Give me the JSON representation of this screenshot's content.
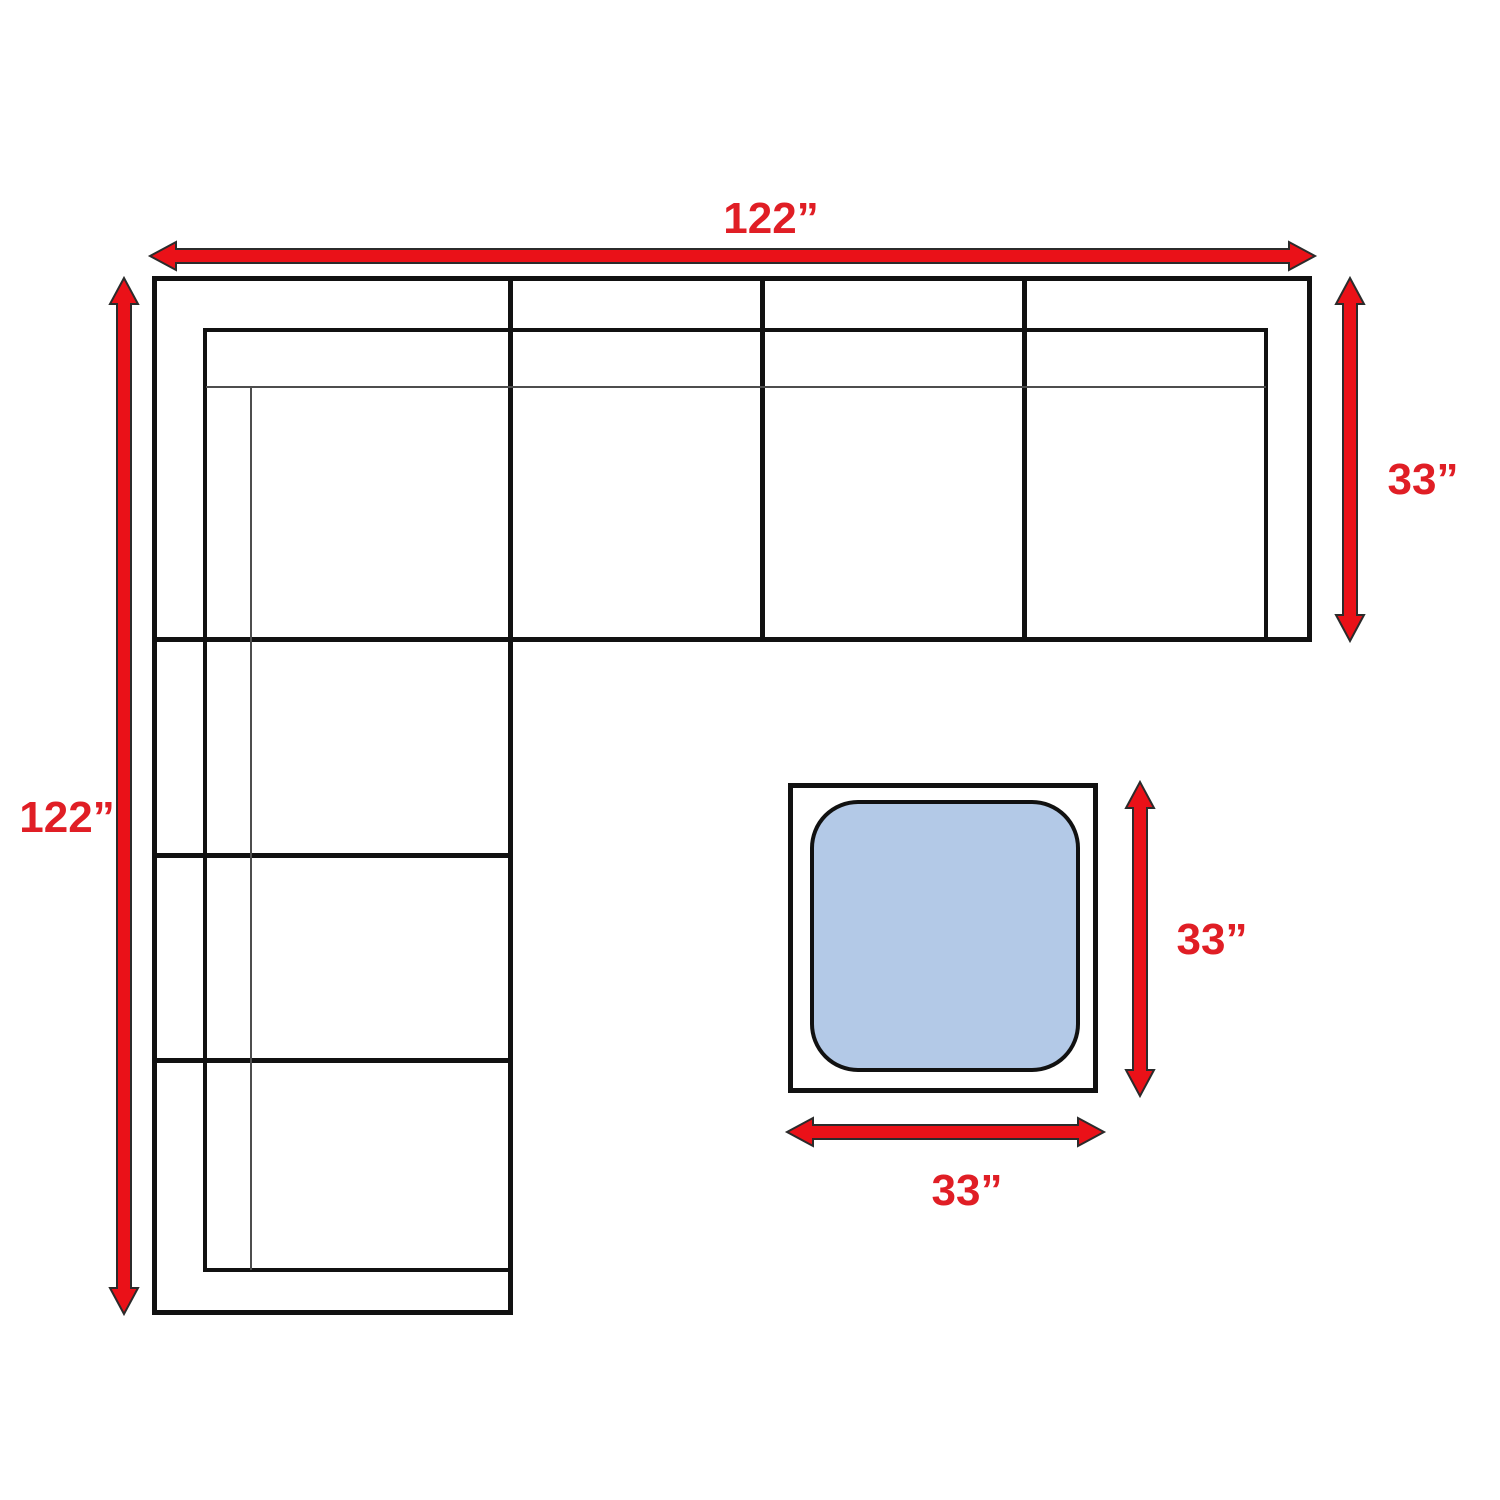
{
  "diagram": {
    "title": "sectional-sofa-with-ottoman-dimension-diagram",
    "labels": {
      "sofa_width_top": "122”",
      "sofa_depth_left": "122”",
      "sofa_arm_right": "33”",
      "ottoman_side_right": "33”",
      "ottoman_side_bottom": "33”"
    },
    "colors": {
      "arrow_red": "#ea1118",
      "label_red": "#e01e25",
      "line_black": "#111111",
      "thin_line_gray": "#4d4d4d",
      "cushion_blue": "#b3c9e7",
      "background": "#ffffff"
    }
  }
}
